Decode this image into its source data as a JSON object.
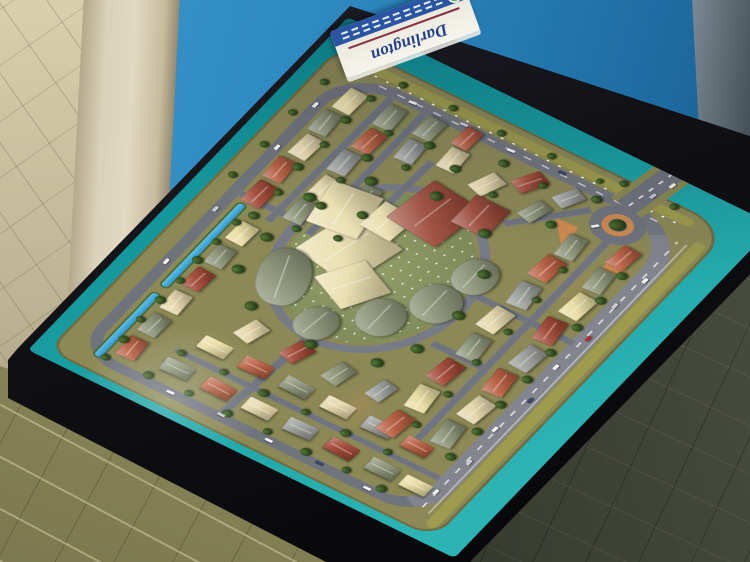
{
  "scene": {
    "description": "Photograph of an architectural scale model of the Darlington residential estate displayed on a black table in front of a blue backdrop",
    "sign": {
      "title": "Darlington"
    },
    "palette": {
      "wall_blue": "#2f8ac1",
      "board_teal": "#1ba1a4",
      "land_olive": "#8c8956",
      "road_gray": "#70747e",
      "canal_blue": "#2f96cf",
      "tree_green": "#2f4a20",
      "island_orange": "#cd8a50",
      "verge_yellow": "#9d9b4e",
      "table_black": "#0d0d10",
      "floor_beige": "#c9c0a2",
      "floor_olive": "#8d8a5c",
      "floor_dark": "#3a3e33",
      "sign_navy": "#24408e",
      "sign_band_blue": "#2a55a4",
      "sign_logo_green": "#2e8f3e"
    },
    "roofs": {
      "t": "#b65c3e",
      "T": "#a04634",
      "s": "#8b9377",
      "c": "#e5d7ab",
      "g": "#9b9e9b",
      "y": "#e8dca2",
      "R": "#9c4a3a",
      "C": "#eadfaf"
    }
  },
  "model": {
    "houses": [
      [
        52,
        74,
        34,
        22,
        -3,
        "t"
      ],
      [
        96,
        74,
        34,
        22,
        2,
        "s"
      ],
      [
        140,
        74,
        34,
        22,
        -2,
        "c"
      ],
      [
        184,
        74,
        34,
        22,
        3,
        "T"
      ],
      [
        228,
        74,
        34,
        22,
        -2,
        "s"
      ],
      [
        272,
        74,
        34,
        22,
        2,
        "y"
      ],
      [
        332,
        56,
        40,
        24,
        2,
        "T"
      ],
      [
        378,
        54,
        38,
        22,
        -2,
        "t"
      ],
      [
        424,
        58,
        38,
        22,
        3,
        "c"
      ],
      [
        468,
        54,
        38,
        22,
        -3,
        "s"
      ],
      [
        512,
        58,
        38,
        22,
        2,
        "y"
      ],
      [
        336,
        104,
        38,
        22,
        -3,
        "s"
      ],
      [
        382,
        106,
        38,
        22,
        2,
        "c"
      ],
      [
        428,
        102,
        38,
        22,
        -2,
        "g"
      ],
      [
        472,
        106,
        38,
        22,
        3,
        "t"
      ],
      [
        516,
        104,
        38,
        22,
        -2,
        "s"
      ],
      [
        350,
        146,
        38,
        22,
        2,
        "y"
      ],
      [
        396,
        148,
        38,
        22,
        -2,
        "s"
      ],
      [
        486,
        148,
        36,
        22,
        -3,
        "g"
      ],
      [
        528,
        146,
        36,
        22,
        2,
        "s"
      ],
      [
        502,
        190,
        36,
        22,
        -2,
        "c"
      ],
      [
        540,
        186,
        34,
        20,
        3,
        "t"
      ],
      [
        54,
        128,
        34,
        22,
        88,
        "s"
      ],
      [
        54,
        178,
        34,
        22,
        92,
        "t"
      ],
      [
        54,
        228,
        34,
        22,
        90,
        "c"
      ],
      [
        54,
        278,
        34,
        22,
        87,
        "g"
      ],
      [
        54,
        328,
        34,
        22,
        93,
        "T"
      ],
      [
        54,
        378,
        34,
        22,
        90,
        "s"
      ],
      [
        54,
        420,
        32,
        20,
        90,
        "y"
      ],
      [
        106,
        142,
        34,
        22,
        90,
        "y"
      ],
      [
        106,
        192,
        34,
        22,
        89,
        "t"
      ],
      [
        106,
        242,
        34,
        22,
        91,
        "s"
      ],
      [
        106,
        292,
        34,
        22,
        90,
        "c"
      ],
      [
        106,
        342,
        34,
        22,
        88,
        "g"
      ],
      [
        106,
        390,
        32,
        20,
        92,
        "t"
      ],
      [
        150,
        160,
        34,
        22,
        15,
        "c"
      ],
      [
        152,
        214,
        34,
        22,
        18,
        "T"
      ],
      [
        150,
        266,
        34,
        22,
        12,
        "s"
      ],
      [
        156,
        316,
        32,
        20,
        10,
        "g"
      ],
      [
        118,
        352,
        40,
        24,
        7,
        "t"
      ],
      [
        168,
        354,
        40,
        24,
        -5,
        "y"
      ],
      [
        218,
        352,
        40,
        24,
        6,
        "T"
      ],
      [
        268,
        356,
        40,
        24,
        -4,
        "s"
      ],
      [
        318,
        352,
        40,
        24,
        5,
        "c"
      ],
      [
        368,
        356,
        40,
        24,
        -6,
        "g"
      ],
      [
        418,
        354,
        40,
        24,
        4,
        "t"
      ],
      [
        462,
        358,
        38,
        22,
        -4,
        "s"
      ],
      [
        138,
        404,
        40,
        24,
        -5,
        "s"
      ],
      [
        188,
        408,
        40,
        24,
        6,
        "c"
      ],
      [
        238,
        406,
        40,
        24,
        -4,
        "t"
      ],
      [
        288,
        410,
        40,
        24,
        5,
        "g"
      ],
      [
        338,
        406,
        40,
        24,
        -5,
        "T"
      ],
      [
        388,
        410,
        40,
        24,
        4,
        "y"
      ],
      [
        436,
        408,
        38,
        22,
        -4,
        "s"
      ],
      [
        482,
        410,
        36,
        22,
        5,
        "t"
      ],
      [
        492,
        238,
        36,
        22,
        20,
        "c"
      ],
      [
        522,
        272,
        36,
        22,
        28,
        "T"
      ],
      [
        488,
        300,
        34,
        20,
        15,
        "s"
      ],
      [
        528,
        318,
        32,
        20,
        25,
        "g"
      ],
      [
        295,
        148,
        85,
        75,
        12,
        "C"
      ],
      [
        350,
        122,
        72,
        58,
        -8,
        "C"
      ],
      [
        262,
        190,
        62,
        55,
        28,
        "C"
      ],
      [
        374,
        176,
        48,
        40,
        5,
        "C"
      ],
      [
        398,
        196,
        80,
        66,
        8,
        "R"
      ],
      [
        438,
        248,
        52,
        42,
        0,
        "R"
      ],
      [
        238,
        242,
        60,
        50,
        0,
        "s",
        1
      ],
      [
        290,
        276,
        62,
        52,
        0,
        "s",
        1
      ],
      [
        352,
        290,
        58,
        46,
        0,
        "s",
        1
      ],
      [
        214,
        126,
        90,
        56,
        -18,
        "s",
        1
      ],
      [
        192,
        196,
        54,
        44,
        6,
        "s",
        1
      ]
    ],
    "trees": [
      [
        40,
        70,
        5
      ],
      [
        75,
        71,
        6
      ],
      [
        112,
        69,
        5
      ],
      [
        150,
        70,
        6
      ],
      [
        188,
        71,
        5
      ],
      [
        226,
        69,
        6
      ],
      [
        262,
        70,
        5
      ],
      [
        300,
        71,
        5
      ],
      [
        360,
        30,
        5
      ],
      [
        420,
        32,
        5
      ],
      [
        480,
        30,
        5
      ],
      [
        540,
        32,
        5
      ],
      [
        590,
        34,
        4
      ],
      [
        320,
        80,
        6
      ],
      [
        366,
        82,
        5
      ],
      [
        412,
        78,
        6
      ],
      [
        458,
        82,
        5
      ],
      [
        504,
        80,
        6
      ],
      [
        548,
        84,
        5
      ],
      [
        330,
        126,
        5
      ],
      [
        376,
        128,
        6
      ],
      [
        422,
        124,
        5
      ],
      [
        468,
        128,
        6
      ],
      [
        514,
        126,
        5
      ],
      [
        344,
        168,
        5
      ],
      [
        390,
        170,
        6
      ],
      [
        480,
        168,
        5
      ],
      [
        524,
        170,
        6
      ],
      [
        44,
        120,
        6
      ],
      [
        46,
        168,
        5
      ],
      [
        44,
        216,
        6
      ],
      [
        46,
        264,
        5
      ],
      [
        44,
        312,
        6
      ],
      [
        46,
        360,
        5
      ],
      [
        44,
        404,
        6
      ],
      [
        94,
        130,
        5
      ],
      [
        96,
        180,
        5
      ],
      [
        94,
        230,
        6
      ],
      [
        96,
        280,
        5
      ],
      [
        94,
        330,
        6
      ],
      [
        96,
        380,
        5
      ],
      [
        200,
        150,
        7
      ],
      [
        188,
        230,
        7
      ],
      [
        206,
        300,
        7
      ],
      [
        250,
        322,
        7
      ],
      [
        320,
        330,
        7
      ],
      [
        390,
        318,
        7
      ],
      [
        444,
        286,
        7
      ],
      [
        462,
        216,
        7
      ],
      [
        440,
        150,
        7
      ],
      [
        380,
        112,
        7
      ],
      [
        300,
        108,
        7
      ],
      [
        240,
        110,
        7
      ],
      [
        130,
        436,
        6
      ],
      [
        180,
        438,
        6
      ],
      [
        230,
        436,
        6
      ],
      [
        280,
        438,
        6
      ],
      [
        330,
        436,
        6
      ],
      [
        380,
        438,
        6
      ],
      [
        430,
        436,
        6
      ],
      [
        476,
        434,
        6
      ],
      [
        150,
        382,
        5
      ],
      [
        210,
        384,
        5
      ],
      [
        270,
        382,
        5
      ],
      [
        330,
        384,
        5
      ],
      [
        390,
        382,
        5
      ],
      [
        446,
        380,
        5
      ],
      [
        510,
        210,
        6
      ],
      [
        548,
        246,
        6
      ],
      [
        500,
        262,
        5
      ],
      [
        544,
        296,
        5
      ],
      [
        498,
        334,
        6
      ],
      [
        560,
        352,
        6
      ],
      [
        586,
        100,
        5
      ],
      [
        588,
        160,
        5
      ],
      [
        586,
        220,
        5
      ],
      [
        588,
        280,
        5
      ],
      [
        586,
        340,
        4
      ],
      [
        598,
        362,
        5
      ],
      [
        600,
        422,
        5
      ]
    ],
    "cars": [
      [
        70,
        450,
        2,
        "#f2f2f2"
      ],
      [
        130,
        454,
        1,
        "#c9ccd2"
      ],
      [
        190,
        449,
        3,
        "#f2f2f2"
      ],
      [
        250,
        455,
        2,
        "#3a4a6a"
      ],
      [
        310,
        450,
        1,
        "#f2f2f2"
      ],
      [
        368,
        454,
        2,
        "#b03030"
      ],
      [
        428,
        450,
        1,
        "#c9ccd2"
      ],
      [
        480,
        455,
        3,
        "#f2f2f2"
      ],
      [
        31,
        150,
        88,
        "#f2f2f2"
      ],
      [
        34,
        210,
        92,
        "#c9ccd2"
      ],
      [
        31,
        270,
        90,
        "#f2f2f2"
      ],
      [
        34,
        330,
        88,
        "#3a4a6a"
      ],
      [
        31,
        390,
        91,
        "#f2f2f2"
      ],
      [
        565,
        120,
        80,
        "#f2f2f2"
      ],
      [
        569,
        180,
        85,
        "#c9ccd2"
      ],
      [
        565,
        240,
        82,
        "#f2f2f2"
      ],
      [
        569,
        300,
        85,
        "#3a4a6a"
      ],
      [
        200,
        42,
        -2,
        "#f2f2f2"
      ],
      [
        300,
        41,
        2,
        "#c9ccd2"
      ],
      [
        420,
        43,
        -1,
        "#f2f2f2"
      ],
      [
        500,
        41,
        1,
        "#f2f2f2"
      ],
      [
        520,
        370,
        40,
        "#f2f2f2"
      ],
      [
        596,
        394,
        10,
        "#c9ccd2"
      ],
      [
        622,
        402,
        8,
        "#f2f2f2"
      ]
    ]
  }
}
